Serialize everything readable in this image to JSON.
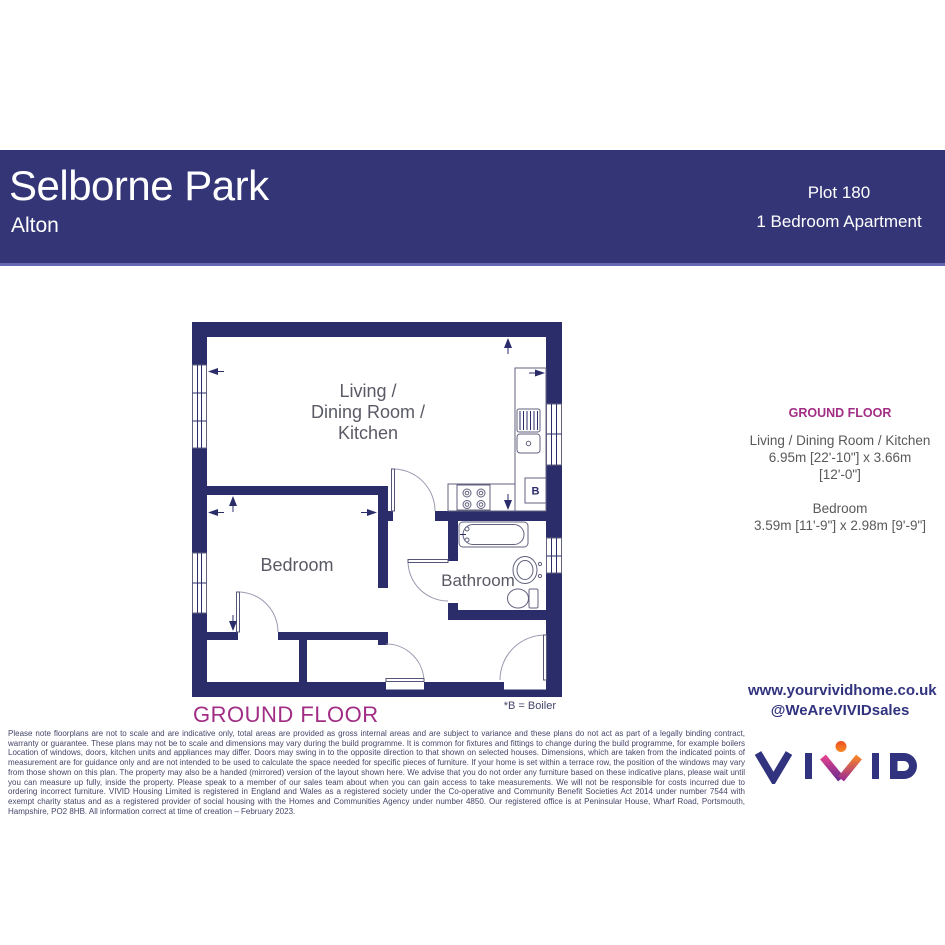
{
  "header": {
    "title": "Selborne Park",
    "subtitle": "Alton",
    "plot": "Plot 180",
    "property_type": "1 Bedroom Apartment"
  },
  "plan": {
    "living_label": "Living /\nDining Room /\nKitchen",
    "bedroom_label": "Bedroom",
    "bathroom_label": "Bathroom",
    "boiler_letter": "B",
    "boiler_note": "*B = Boiler",
    "floor_title": "GROUND FLOOR"
  },
  "dimensions_panel": {
    "heading": "GROUND FLOOR",
    "rooms": [
      {
        "label": "Living / Dining Room / Kitchen",
        "size": "6.95m [22'-10\"] x 3.66m [12'-0\"]"
      },
      {
        "label": "Bedroom",
        "size": "3.59m [11'-9\"]  x 2.98m [9'-9\"]"
      }
    ]
  },
  "footer": {
    "disclaimer": "Please note floorplans are not to scale and are indicative only, total areas are provided as gross internal areas and are subject to variance and these plans do not act as part of a legally binding contract, warranty or guarantee. These plans may not be to scale and dimensions may vary during the build programme. It is common for fixtures and fittings to change during the build programme, for example boilers  Location of windows, doors, kitchen units and appliances may differ. Doors may swing in to the opposite direction to that shown on selected houses. Dimensions, which are taken from the indicated points of measurement are for guidance only and are not intended to be used to calculate the space needed for specific pieces of furniture. If your home is set within a terrace row, the position of the windows may vary from those shown on this plan. The property may also be a handed (mirrored) version of the layout shown here.  We advise that you do not order any furniture based on these indicative plans, please wait until you can measure up fully, inside the property. Please speak to a member of our sales team about when you can gain access to take measurements. We will not be responsible for costs incurred due to ordering incorrect furniture.  VIVID Housing Limited is registered in England and Wales as a registered society under the Co-operative and Community Benefit Societies Act 2014 under number 7544 with exempt charity status and as a registered provider of social housing with the Homes and Communities Agency under number 4850. Our registered office is at Peninsular House, Wharf Road, Portsmouth, Hampshire, PO2 8HB.  All information correct at time of creation – February 2023.",
    "website": "www.yourvividhome.co.uk",
    "social_handle": "@WeAreVIVIDsales",
    "logo_text": "VIVID"
  },
  "colors": {
    "band_navy": "#343577",
    "wall_navy": "#2b2d6b",
    "magenta": "#a12d84",
    "text_gray": "#595959",
    "logo_navy": "#31337f",
    "logo_orange": "#f58229",
    "logo_pink": "#e0408d"
  }
}
